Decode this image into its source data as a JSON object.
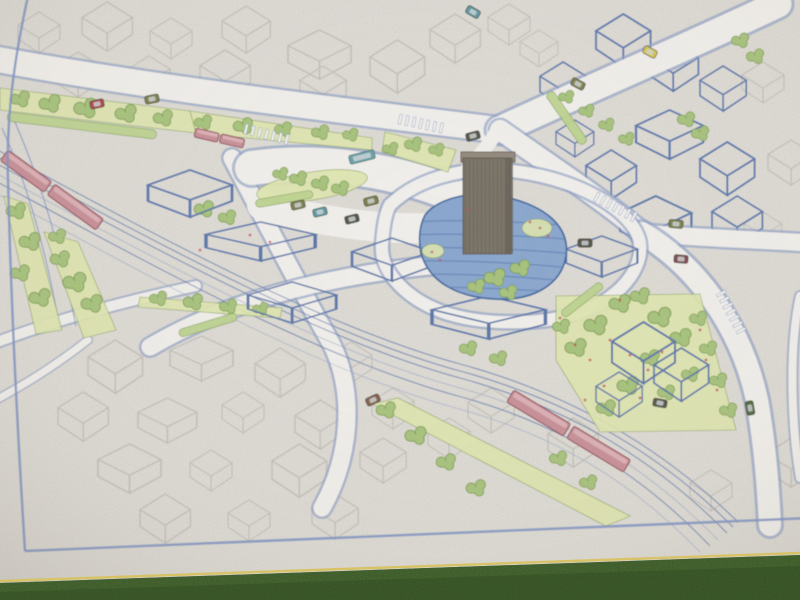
{
  "scene": {
    "description": "Outdoor photograph of a hand-drawn isometric urban redevelopment plan on white paper, bottom edge resting above dark green turf",
    "features": [
      "hand-drawn-site-plan",
      "blue-ink-frame-border",
      "pencil-sketched-city-blocks",
      "ink-outlined-buildings",
      "diagonal-railway-corridor",
      "red-two-car-trains",
      "red-tram",
      "station-plaza-and-parking",
      "central-high-rise-tower",
      "blue-water-plaza",
      "landscaped-green-strips",
      "street-trees",
      "road-intersections-with-crosswalks",
      "small-colored-cars",
      "green-turf-foreground"
    ],
    "train_count": 3,
    "tower_count": 1
  },
  "colors": {
    "paper": "#e8e6e2",
    "road": "#efede9",
    "ink": "#5b74a8",
    "inkLight": "#8d9ec3",
    "pencil": "#aaa69f",
    "border": "#7d90bf",
    "pond": "#8aa6cc",
    "pondLine": "#5c7cb0",
    "pondEdge": "#47689f",
    "treeFill": "#a6c17b",
    "treeEdge": "#7d9b55",
    "shrub": "#bcd18f",
    "lawn": "#dde4ad",
    "towerFront": "#7c7469",
    "towerHatch": "#645c52",
    "towerTop": "#93897c",
    "trainFill": "#c68e96",
    "trainTop": "#dab0b4",
    "trainOutline": "#8e515c",
    "busTeal": "#6ba2a8",
    "carOlive": "#7c7f4e",
    "carYellow": "#d2c452",
    "carTeal": "#5f98a0",
    "carMaroon": "#7c4b53",
    "carDark": "#56564c",
    "carBrown": "#84604e",
    "carRed": "#a8474c",
    "carGreen": "#4f6b3c",
    "flower": "#c25862",
    "grass": "#3c5a2a",
    "paperEdge": "#d7c266"
  }
}
